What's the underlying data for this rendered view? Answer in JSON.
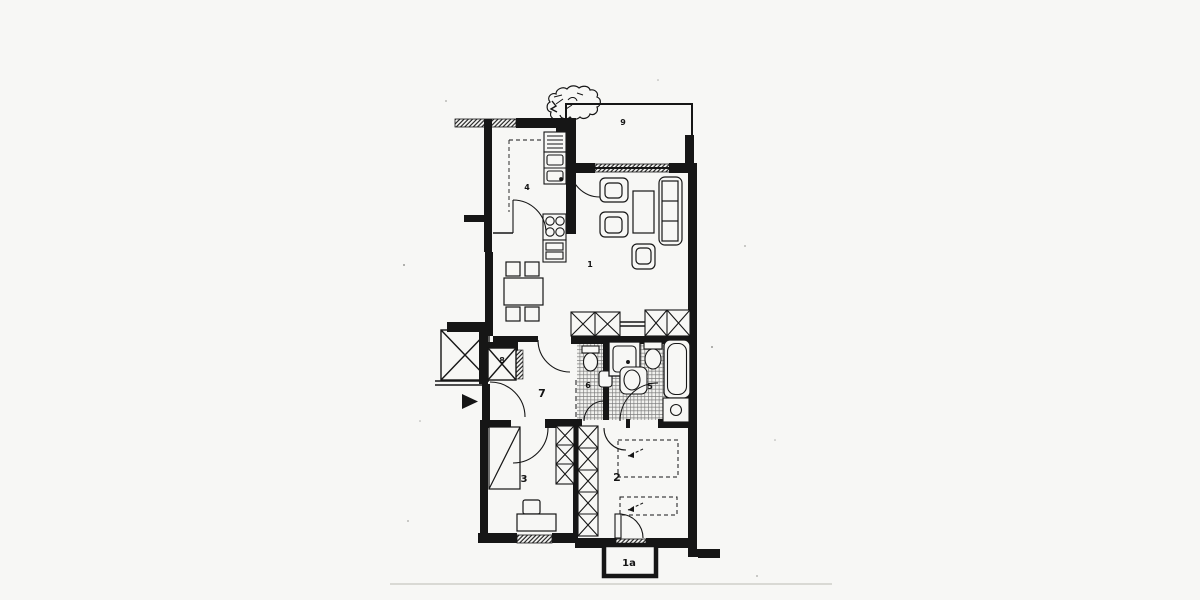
{
  "plan": {
    "colors": {
      "ink": "#1a1a1a",
      "paper": "#f7f7f5",
      "tile_line": "#777777"
    },
    "rooms": [
      {
        "id": "living-room",
        "label": "1"
      },
      {
        "id": "balcony-lower",
        "label": "1a"
      },
      {
        "id": "bedroom-right",
        "label": "2"
      },
      {
        "id": "bedroom-left",
        "label": "3"
      },
      {
        "id": "kitchen",
        "label": "4"
      },
      {
        "id": "bathroom",
        "label": "5"
      },
      {
        "id": "wc",
        "label": "6"
      },
      {
        "id": "hallway",
        "label": "7"
      },
      {
        "id": "shaft",
        "label": "8"
      },
      {
        "id": "balcony-upper",
        "label": "9"
      }
    ],
    "icons": {
      "entrance_arrow": "right-filled-triangle"
    }
  }
}
